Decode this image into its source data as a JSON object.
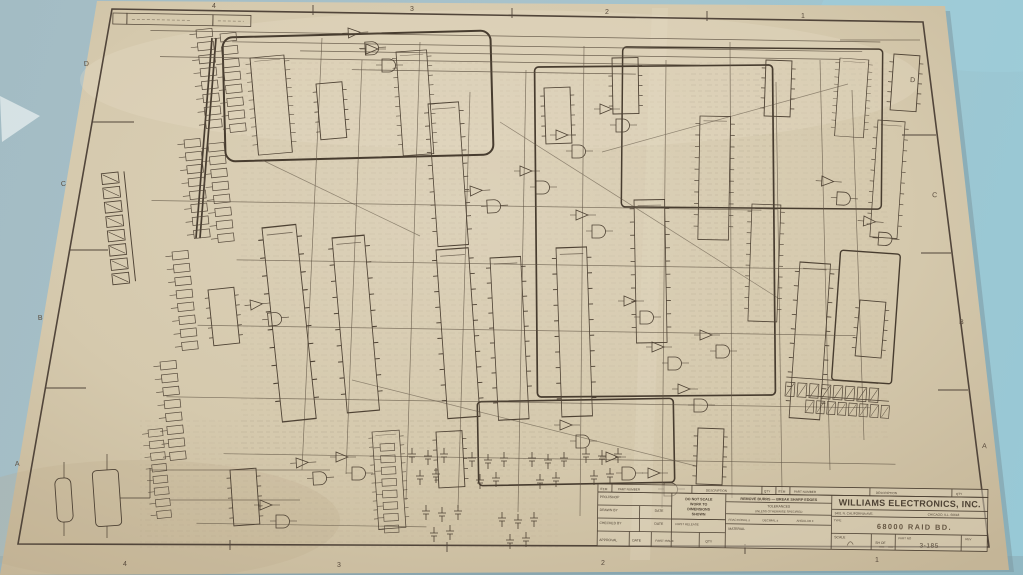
{
  "photo": {
    "description": "Photograph of an aged Williams Electronics engineering schematic sheet lying on a light blue surface",
    "background_color": "#a7c2cb",
    "paper_color": "#d6caaf",
    "ink_color": "#4e4234"
  },
  "sheet": {
    "zones": {
      "left": [
        "D",
        "C",
        "B",
        "A"
      ],
      "right": [
        "D",
        "C",
        "B",
        "A"
      ],
      "top": [
        "4",
        "3",
        "2",
        "1"
      ],
      "bottom": [
        "4",
        "3",
        "2",
        "1"
      ]
    }
  },
  "title_block": {
    "parts_list_header": {
      "item": "ITEM",
      "part_number": "PART NUMBER",
      "description": "DESCRIPTION",
      "qty": "QTY"
    },
    "fields": {
      "proj_shop": "PROJ/SHOP",
      "drawn_by": "DRAWN BY",
      "drawn_date": "DATE",
      "checked_by": "CHECKED BY",
      "checked_date": "DATE",
      "first_release": "FIRST RELEASE",
      "approval": "APPROVAL",
      "approval_date": "DATE",
      "first_issue": "FIRST ISSUE",
      "qty": "QTY"
    },
    "do_not_scale_lines": [
      "DO NOT SCALE",
      "WORK TO",
      "DIMENSIONS",
      "SHOWN"
    ],
    "tolerances": {
      "header": "REMOVE BURRS — BREAK SHARP EDGES",
      "title": "TOLERANCES",
      "subtitle": "UNLESS OTHERWISE SPECIFIED",
      "fractional": "FRACTIONAL ±",
      "decimal": "DECIMAL ±",
      "angular": "ANGULAR ±",
      "material": "MATERIAL"
    },
    "company": {
      "name": "WILLIAMS ELECTRONICS, INC.",
      "address": "3401 N. CALIFORNIA AVE.",
      "city": "CHICAGO, ILL. 60618",
      "type_label": "TYPE",
      "drawing_title": "68000 RAID BD.",
      "scale_label": "SCALE",
      "sheet_of_label": "SH        OF",
      "part_no_label": "PART NO",
      "part_no": "3-185",
      "rev_label": "REV"
    }
  }
}
